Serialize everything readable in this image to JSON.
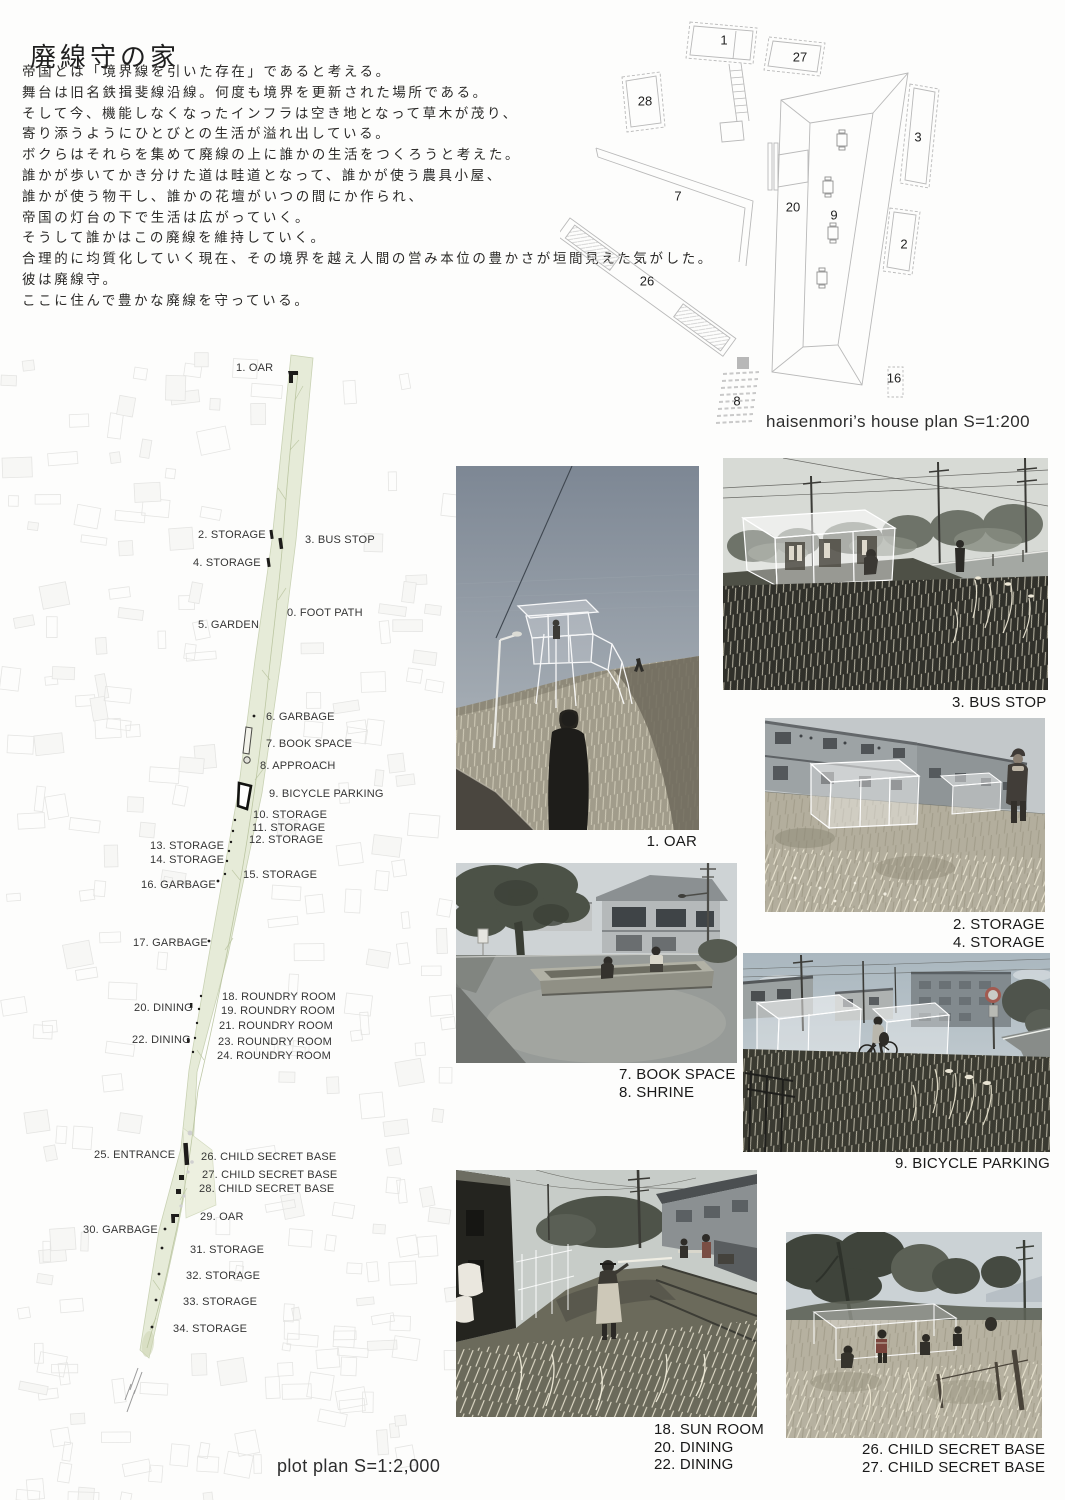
{
  "title": "廃線守の家",
  "intro_lines": [
    "帝国とは「境界線を引いた存在」であると考える。",
    "舞台は旧名鉄揖斐線沿線。何度も境界を更新された場所である。",
    "そして今、機能しなくなったインフラは空き地となって草木が茂り、",
    "寄り添うようにひとびとの生活が溢れ出している。",
    "ボクらはそれらを集めて廃線の上に誰かの生活をつくろうと考えた。",
    "誰かが歩いてかき分けた道は畦道となって、誰かが使う農具小屋、",
    "誰かが使う物干し、誰かの花壇がいつの間にか作られ、",
    "帝国の灯台の下で生活は広がっていく。",
    "そうして誰かはこの廃線を維持していく。",
    "合理的に均質化していく現在、その境界を越え人間の営み本位の豊かさが垣間見えた気がした。",
    "彼は廃線守。",
    "ここに住んで豊かな廃線を守っている。"
  ],
  "house_plan": {
    "caption": "haisenmori’s house plan S=1:200",
    "numbers": [
      {
        "n": "1",
        "x": 724,
        "y": 40
      },
      {
        "n": "27",
        "x": 800,
        "y": 57
      },
      {
        "n": "28",
        "x": 645,
        "y": 101
      },
      {
        "n": "3",
        "x": 918,
        "y": 137
      },
      {
        "n": "7",
        "x": 678,
        "y": 196
      },
      {
        "n": "20",
        "x": 793,
        "y": 207
      },
      {
        "n": "9",
        "x": 834,
        "y": 215
      },
      {
        "n": "2",
        "x": 904,
        "y": 244
      },
      {
        "n": "26",
        "x": 647,
        "y": 281
      },
      {
        "n": "16",
        "x": 894,
        "y": 378
      },
      {
        "n": "8",
        "x": 737,
        "y": 401
      }
    ]
  },
  "plot_plan": {
    "caption": "plot plan S=1:2,000",
    "labels": [
      {
        "text": "1. OAR",
        "x": 236,
        "y": 363
      },
      {
        "text": "2. STORAGE",
        "x": 198,
        "y": 530
      },
      {
        "text": "3. BUS STOP",
        "x": 305,
        "y": 535
      },
      {
        "text": "4. STORAGE",
        "x": 193,
        "y": 558
      },
      {
        "text": "0. FOOT PATH",
        "x": 287,
        "y": 608
      },
      {
        "text": "5. GARDEN",
        "x": 198,
        "y": 620
      },
      {
        "text": "6. GARBAGE",
        "x": 266,
        "y": 712
      },
      {
        "text": "7. BOOK SPACE",
        "x": 266,
        "y": 739
      },
      {
        "text": "8. APPROACH",
        "x": 260,
        "y": 761
      },
      {
        "text": "9. BICYCLE PARKING",
        "x": 269,
        "y": 789
      },
      {
        "text": "10. STORAGE",
        "x": 253,
        "y": 810
      },
      {
        "text": "11. STORAGE",
        "x": 252,
        "y": 823
      },
      {
        "text": "12. STORAGE",
        "x": 249,
        "y": 835
      },
      {
        "text": "13. STORAGE",
        "x": 150,
        "y": 841
      },
      {
        "text": "14. STORAGE",
        "x": 150,
        "y": 855
      },
      {
        "text": "15. STORAGE",
        "x": 243,
        "y": 870
      },
      {
        "text": "16. GARBAGE",
        "x": 141,
        "y": 880
      },
      {
        "text": "17. GARBAGE",
        "x": 133,
        "y": 938
      },
      {
        "text": "18. ROUNDRY ROOM",
        "x": 222,
        "y": 992
      },
      {
        "text": "20. DINING",
        "x": 134,
        "y": 1003
      },
      {
        "text": "19. ROUNDRY ROOM",
        "x": 221,
        "y": 1006
      },
      {
        "text": "21. ROUNDRY ROOM",
        "x": 219,
        "y": 1021
      },
      {
        "text": "22. DINING",
        "x": 132,
        "y": 1035
      },
      {
        "text": "23. ROUNDRY ROOM",
        "x": 218,
        "y": 1037
      },
      {
        "text": "24. ROUNDRY ROOM",
        "x": 217,
        "y": 1051
      },
      {
        "text": "25. ENTRANCE",
        "x": 94,
        "y": 1150
      },
      {
        "text": "26. CHILD SECRET BASE",
        "x": 201,
        "y": 1152
      },
      {
        "text": "27. CHILD SECRET BASE",
        "x": 202,
        "y": 1170
      },
      {
        "text": "28. CHILD SECRET BASE",
        "x": 199,
        "y": 1184
      },
      {
        "text": "29. OAR",
        "x": 200,
        "y": 1212
      },
      {
        "text": "30. GARBAGE",
        "x": 83,
        "y": 1225
      },
      {
        "text": "31. STORAGE",
        "x": 190,
        "y": 1245
      },
      {
        "text": "32. STORAGE",
        "x": 186,
        "y": 1271
      },
      {
        "text": "33. STORAGE",
        "x": 183,
        "y": 1297
      },
      {
        "text": "34. STORAGE",
        "x": 173,
        "y": 1324
      }
    ]
  },
  "photos": [
    {
      "id": "oar",
      "captions": [
        "1. OAR"
      ]
    },
    {
      "id": "bus-stop",
      "captions": [
        "3. BUS STOP"
      ]
    },
    {
      "id": "storage",
      "captions": [
        "2. STORAGE",
        "4. STORAGE"
      ]
    },
    {
      "id": "book-space",
      "captions": [
        "7. BOOK SPACE",
        "8. SHRINE"
      ]
    },
    {
      "id": "bicycle-parking",
      "captions": [
        "9. BICYCLE PARKING"
      ]
    },
    {
      "id": "sun-room",
      "captions": [
        "18. SUN ROOM",
        "20. DINING",
        "22. DINING"
      ]
    },
    {
      "id": "child-secret-base",
      "captions": [
        "26. CHILD SECRET BASE",
        "27. CHILD SECRET BASE"
      ]
    }
  ],
  "colors": {
    "strip_green": "#e6ebd8",
    "strip_edge": "#c9d2b4",
    "map_line": "#e5e5e3",
    "ink": "#1d1c1a"
  }
}
